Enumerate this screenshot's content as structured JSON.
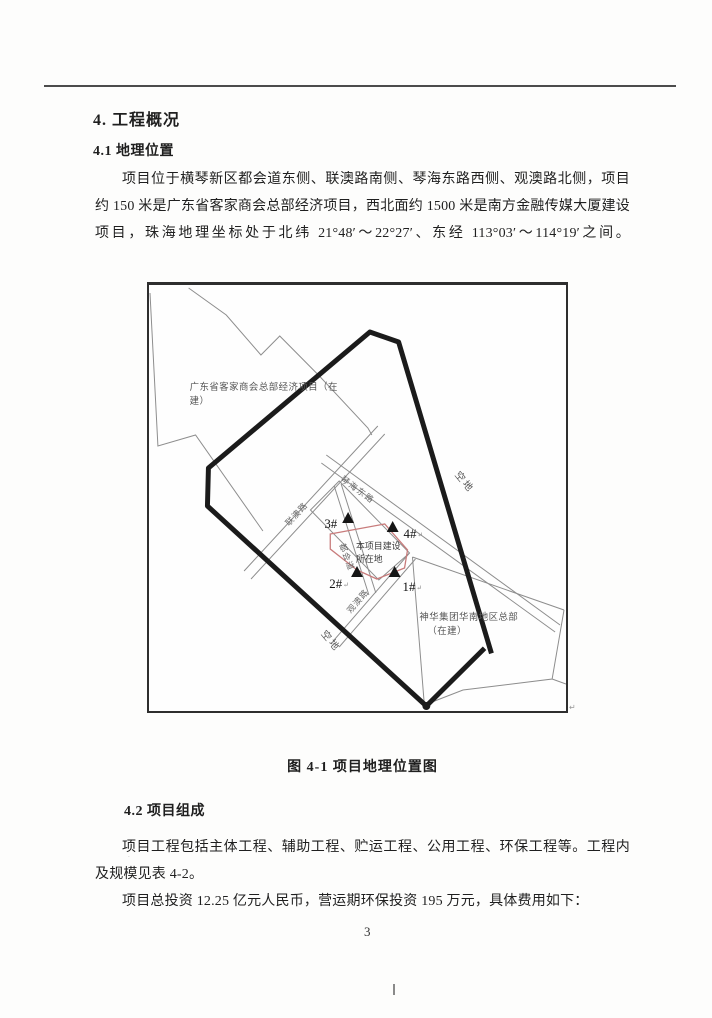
{
  "document": {
    "section_heading": "4. 工程概况",
    "sub_heading_1": "4.1 地理位置",
    "para1_lines": [
      "项目位于横琴新区都会道东侧、联澳路南侧、琴海东路西侧、观澳路北侧，项目北面",
      "约 150 米是广东省客家商会总部经济项目，西北面约 1500 米是南方金融传媒大厦建设",
      "项目，珠海地理坐标处于北纬 21°48′～22°27′、东经 113°03′～114°19′之间。"
    ],
    "figure_caption": "图 4-1 项目地理位置图",
    "sub_heading_2": "4.2 项目组成",
    "para2_lines": [
      "项目工程包括主体工程、辅助工程、贮运工程、公用工程、环保工程等。工程内容",
      "及规模见表 4-2。"
    ],
    "para3": "项目总投资 12.25 亿元人民币，营运期环保投资 195 万元，具体费用如下：",
    "page_number": "3"
  },
  "map": {
    "parcel_nw_line1": "广东省客家商会总部经济项目（在",
    "parcel_nw_line2": "建）",
    "site_line1": "本项目建设",
    "site_line2": "所在地",
    "parcel_se_line1": "神华集团华南地区总部",
    "parcel_se_line2": "（在建）",
    "road_qinhai_east": "琴海东路",
    "road_lianao": "联澳路",
    "road_duhui": "都会道",
    "road_guanao": "观澳路",
    "vacant_right": "空地",
    "vacant_bottom": "空地",
    "marker_3": "3#",
    "marker_4": "4#",
    "marker_2": "2#",
    "marker_1": "1#",
    "return_mark": "↵",
    "colors": {
      "boundary": "#1b1b1b",
      "site_outline": "#c87b7b",
      "thin_line": "#8d8d8d"
    }
  }
}
